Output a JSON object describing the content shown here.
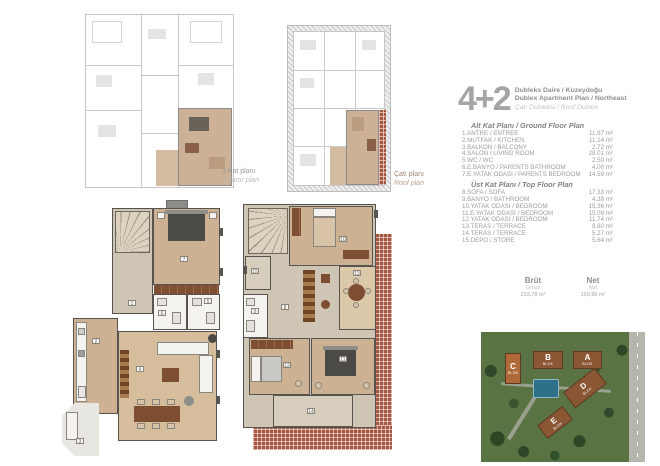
{
  "header": {
    "big": "4+2",
    "title_tr": "Dubleks Daire / Kuzeydoğu",
    "title_en": "Dublex Apartment Plan / Northeast",
    "subtitle": "Çatı Dubleksi / Roof Dublex"
  },
  "mini_plans": {
    "floor3": {
      "label_tr": "3.Kat planı",
      "label_en": "3.Floor plan"
    },
    "roof": {
      "label_tr": "Çatı planı",
      "label_en": "Roof plan"
    }
  },
  "ground_floor": {
    "title": "Alt Kat Planı / Ground Floor Plan",
    "rooms": [
      {
        "num": "1",
        "name": "1.ANTRE / ENTREE",
        "area": "11.97 m²"
      },
      {
        "num": "2",
        "name": "2.MUTFAK / KITCHEN",
        "area": "11.24 m²"
      },
      {
        "num": "3",
        "name": "3.BALKON / BALCONY",
        "area": "2.72 m²"
      },
      {
        "num": "4",
        "name": "4.SALON / LIVING ROOM",
        "area": "28.01 m²"
      },
      {
        "num": "5",
        "name": "5.WC / WC",
        "area": "2.50 m²"
      },
      {
        "num": "6",
        "name": "6.E.BANYO / PARENTS BATHROOM",
        "area": "4.00 m²"
      },
      {
        "num": "7",
        "name": "7.E.YATAK ODASI / PARENTS BEDROOM",
        "area": "14.59 m²"
      }
    ]
  },
  "top_floor": {
    "title": "Üst Kat Planı / Top Floor Plan",
    "rooms": [
      {
        "num": "8",
        "name": "8.SOFA / SOFA",
        "area": "17.33 m²"
      },
      {
        "num": "9",
        "name": "9.BANYO / BATHROOM",
        "area": "4.38 m²"
      },
      {
        "num": "10",
        "name": "10.YATAK ODASI / BEDROOM",
        "area": "15.36 m²"
      },
      {
        "num": "11",
        "name": "11.E.YATAK ODASI / BEDROOM",
        "area": "15.09 m²"
      },
      {
        "num": "12",
        "name": "12.YATAK ODASI / BEDROOM",
        "area": "11.74 m²"
      },
      {
        "num": "13",
        "name": "13.TERAS / TERRACE",
        "area": "9.80 m²"
      },
      {
        "num": "14",
        "name": "14.TERAS / TERRACE",
        "area": "5.27 m²"
      },
      {
        "num": "15",
        "name": "15.DEPO / STORE",
        "area": "5.64 m²"
      }
    ]
  },
  "totals": {
    "gross_label": "Brüt",
    "gross_sub": "Gross",
    "gross_value": "233,78 m²",
    "net_label": "Net",
    "net_sub": "Net",
    "net_value": "160,86 m²"
  },
  "site_plan": {
    "blocks": [
      {
        "letter": "A",
        "sub": "BLOK"
      },
      {
        "letter": "B",
        "sub": "BLOK"
      },
      {
        "letter": "C",
        "sub": "BLOK"
      },
      {
        "letter": "D",
        "sub": "BLOK"
      },
      {
        "letter": "E",
        "sub": "BLOK"
      }
    ]
  },
  "colors": {
    "highlight_tan": "#cdb193",
    "brick_red": "#a8553e",
    "text_gray": "#9a9a9a",
    "wall_dark": "#57534e"
  }
}
